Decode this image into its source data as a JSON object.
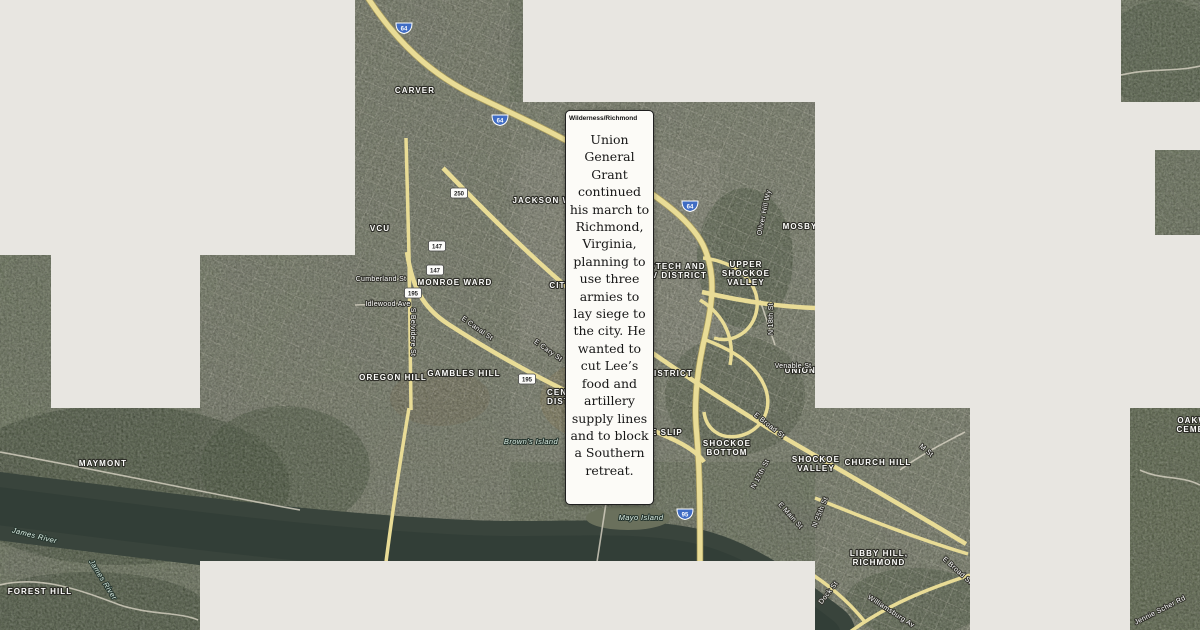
{
  "popup": {
    "title": "Wilderness/Richmond",
    "body": "Union General Grant continued his march to Richmond, Virginia, planning to use three armies to lay siege to the city. He wanted to cut Lee’s food and artillery supply lines and to block a Southern retreat."
  },
  "map": {
    "labels": [
      {
        "text": "CARVER",
        "kind": "district",
        "x": 415,
        "y": 93
      },
      {
        "text": "VCU",
        "kind": "district",
        "x": 380,
        "y": 231
      },
      {
        "text": "JACKSON WARD",
        "kind": "district",
        "x": 552,
        "y": 203
      },
      {
        "text": "MONROE WARD",
        "kind": "district",
        "x": 455,
        "y": 285
      },
      {
        "text": "OREGON HILL",
        "kind": "district",
        "x": 393,
        "y": 380
      },
      {
        "text": "GAMBLES HILL",
        "kind": "district",
        "x": 464,
        "y": 376
      },
      {
        "text": "CITY CENTER",
        "kind": "district",
        "x": 582,
        "y": 288
      },
      {
        "text": "CENTRAL DISTRICT",
        "kind": "district",
        "x": 570,
        "y": 395,
        "lines": [
          "CENTRAL",
          "DISTRICT"
        ]
      },
      {
        "text": "BIOTECH AND MCV DISTRICT",
        "kind": "district",
        "x": 672,
        "y": 269,
        "lines": [
          "BIOTECH AND",
          "MCV DISTRICT"
        ]
      },
      {
        "text": "UPPER SHOCKOE VALLEY",
        "kind": "district",
        "x": 746,
        "y": 267,
        "lines": [
          "UPPER",
          "SHOCKOE",
          "VALLEY"
        ]
      },
      {
        "text": "MOSBY",
        "kind": "district",
        "x": 800,
        "y": 229
      },
      {
        "text": "UNION HILL",
        "kind": "district",
        "x": 813,
        "y": 373
      },
      {
        "text": "DISTRICT",
        "kind": "district",
        "x": 670,
        "y": 376
      },
      {
        "text": "SHOCKOE SLIP",
        "kind": "district",
        "x": 646,
        "y": 435
      },
      {
        "text": "SHOCKOE BOTTOM",
        "kind": "district",
        "x": 727,
        "y": 446,
        "lines": [
          "SHOCKOE",
          "BOTTOM"
        ]
      },
      {
        "text": "SHOCKOE VALLEY",
        "kind": "district",
        "x": 816,
        "y": 462,
        "lines": [
          "SHOCKOE",
          "VALLEY"
        ]
      },
      {
        "text": "CHURCH HILL",
        "kind": "district",
        "x": 878,
        "y": 465
      },
      {
        "text": "LIBBY HILL, RICHMOND",
        "kind": "district",
        "x": 879,
        "y": 556,
        "lines": [
          "LIBBY HILL,",
          "RICHMOND"
        ]
      },
      {
        "text": "MAYMONT",
        "kind": "district",
        "x": 103,
        "y": 466
      },
      {
        "text": "FOREST HILL",
        "kind": "district",
        "x": 40,
        "y": 594
      },
      {
        "text": "OAKWOOD CEMETERY",
        "kind": "district",
        "x": 1203,
        "y": 423,
        "lines": [
          "OAKWOOD",
          "CEMETERY"
        ]
      },
      {
        "text": "Cumberland St",
        "kind": "street",
        "x": 381,
        "y": 281
      },
      {
        "text": "Idlewood Ave",
        "kind": "street",
        "x": 388,
        "y": 306
      },
      {
        "text": "S Belvidere St",
        "kind": "street",
        "x": 411,
        "y": 332,
        "rot": 90
      },
      {
        "text": "E Canal St",
        "kind": "street",
        "x": 476,
        "y": 330,
        "rot": 35
      },
      {
        "text": "E Cary St",
        "kind": "street",
        "x": 547,
        "y": 352,
        "rot": 35
      },
      {
        "text": "Venable St",
        "kind": "street",
        "x": 793,
        "y": 368
      },
      {
        "text": "Oliver Hill Wy",
        "kind": "street",
        "x": 766,
        "y": 213,
        "rot": -78
      },
      {
        "text": "N 18th St",
        "kind": "street",
        "x": 773,
        "y": 319,
        "rot": -90
      },
      {
        "text": "E Broad St",
        "kind": "street",
        "x": 768,
        "y": 427,
        "rot": 38
      },
      {
        "text": "N 17th St",
        "kind": "street",
        "x": 762,
        "y": 475,
        "rot": -62
      },
      {
        "text": "E Main St",
        "kind": "street",
        "x": 789,
        "y": 517,
        "rot": 48
      },
      {
        "text": "M St",
        "kind": "street",
        "x": 925,
        "y": 452,
        "rot": 40
      },
      {
        "text": "N 25th St",
        "kind": "street",
        "x": 822,
        "y": 513,
        "rot": -68
      },
      {
        "text": "Dock St",
        "kind": "street",
        "x": 830,
        "y": 594,
        "rot": -52
      },
      {
        "text": "Williamsburg Av",
        "kind": "street",
        "x": 890,
        "y": 613,
        "rot": 33
      },
      {
        "text": "E Broad St",
        "kind": "street",
        "x": 956,
        "y": 572,
        "rot": 42
      },
      {
        "text": "Jennie Scher Rd",
        "kind": "street",
        "x": 1161,
        "y": 612,
        "rot": -27
      },
      {
        "text": "James River",
        "kind": "water",
        "x": 34,
        "y": 538,
        "rot": 14
      },
      {
        "text": "James River",
        "kind": "water",
        "x": 101,
        "y": 581,
        "rot": 58
      },
      {
        "text": "Brown's Island",
        "kind": "water",
        "x": 531,
        "y": 444
      },
      {
        "text": "Mayo Island",
        "kind": "water",
        "x": 641,
        "y": 520
      }
    ],
    "shields": [
      {
        "num": "64",
        "kind": "interstate",
        "x": 404,
        "y": 28
      },
      {
        "num": "64",
        "kind": "interstate",
        "x": 500,
        "y": 120
      },
      {
        "num": "64",
        "kind": "interstate",
        "x": 690,
        "y": 206
      },
      {
        "num": "95",
        "kind": "interstate",
        "x": 685,
        "y": 514
      },
      {
        "num": "250",
        "kind": "route",
        "x": 459,
        "y": 193
      },
      {
        "num": "147",
        "kind": "route",
        "x": 437,
        "y": 246
      },
      {
        "num": "147",
        "kind": "route",
        "x": 435,
        "y": 270
      },
      {
        "num": "195",
        "kind": "route",
        "x": 413,
        "y": 293
      },
      {
        "num": "195",
        "kind": "route",
        "x": 527,
        "y": 379
      }
    ]
  }
}
